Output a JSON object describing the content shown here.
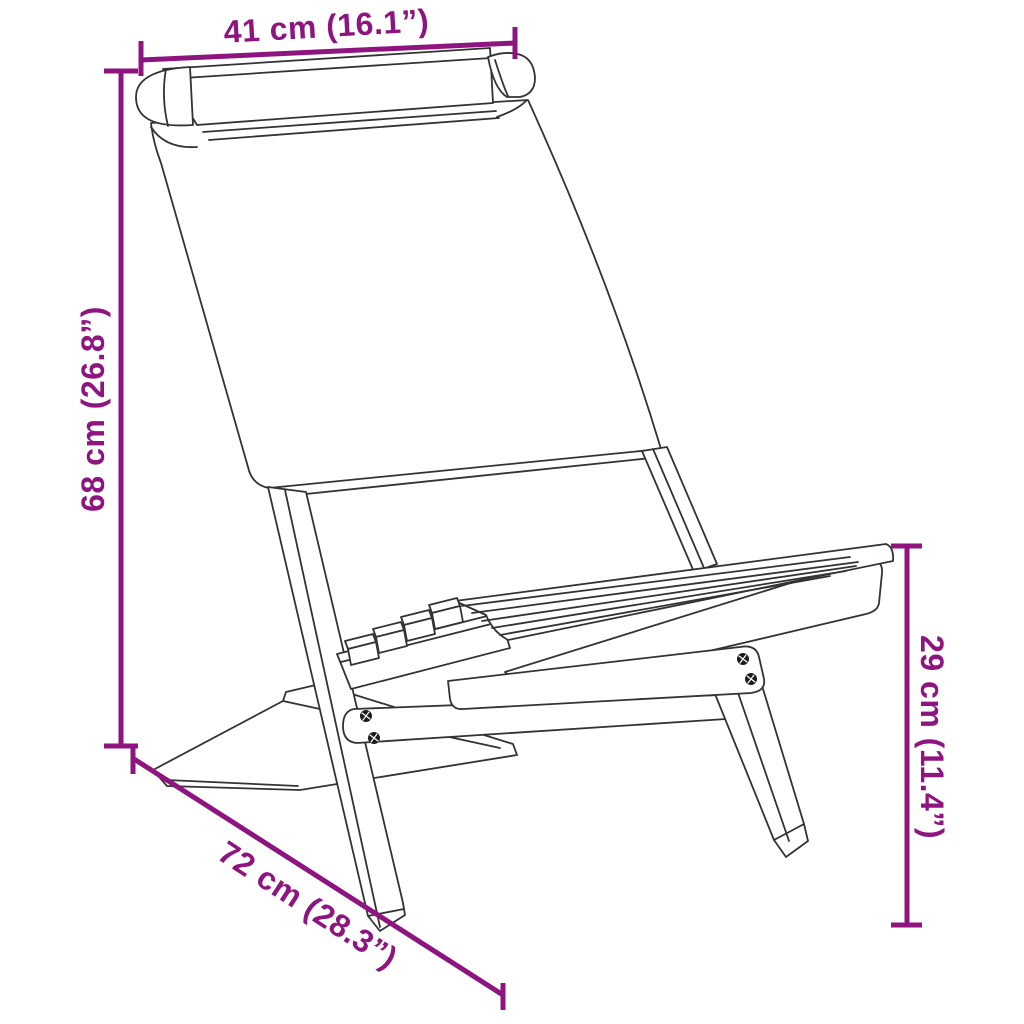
{
  "diagram": {
    "title": "folding-chair-dimension-diagram",
    "background_color": "#ffffff",
    "line_color": "#333333",
    "accent_color": "#8E1480",
    "dimensions": {
      "top_width": {
        "label": "41 cm (16.1”)",
        "value_cm": 41,
        "value_in": 16.1
      },
      "left_height": {
        "label": "68 cm (26.8”)",
        "value_cm": 68,
        "value_in": 26.8
      },
      "right_height": {
        "label": "29 cm (11.4”)",
        "value_cm": 29,
        "value_in": 11.4
      },
      "bottom_depth": {
        "label": "72 cm (28.3”)",
        "value_cm": 72,
        "value_in": 28.3
      }
    }
  }
}
